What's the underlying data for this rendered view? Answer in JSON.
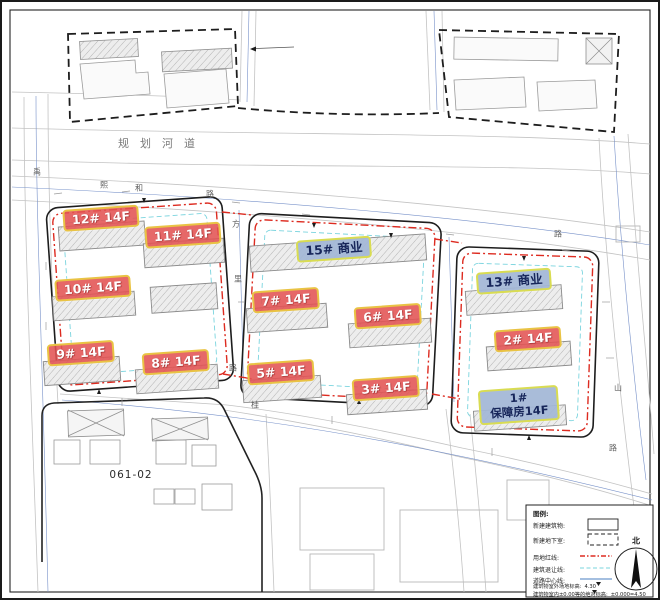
{
  "site": {
    "river_label": "规划河道",
    "parcel_id": "061-02",
    "north_label": "北",
    "roads": {
      "xihe": [
        "熙",
        "和",
        "路"
      ],
      "gap_left": [
        "方",
        "里",
        "路"
      ],
      "right_edge": [
        "山",
        "路"
      ],
      "top_right": "路",
      "bottom": "桂",
      "left_edge": "禹"
    },
    "buildings": [
      {
        "id": "12",
        "label": "12# 14F",
        "type": "residential"
      },
      {
        "id": "11",
        "label": "11# 14F",
        "type": "residential"
      },
      {
        "id": "10",
        "label": "10# 14F",
        "type": "residential"
      },
      {
        "id": "9",
        "label": "9# 14F",
        "type": "residential"
      },
      {
        "id": "8",
        "label": "8# 14F",
        "type": "residential"
      },
      {
        "id": "15",
        "label": "15# 商业",
        "type": "commercial"
      },
      {
        "id": "7",
        "label": "7# 14F",
        "type": "residential"
      },
      {
        "id": "6",
        "label": "6# 14F",
        "type": "residential"
      },
      {
        "id": "5",
        "label": "5# 14F",
        "type": "residential"
      },
      {
        "id": "3",
        "label": "3# 14F",
        "type": "residential"
      },
      {
        "id": "13",
        "label": "13# 商业",
        "type": "commercial"
      },
      {
        "id": "2",
        "label": "2# 14F",
        "type": "residential"
      },
      {
        "id": "1",
        "label": "1#",
        "sublabel": "保障房14F",
        "type": "affordable-housing"
      }
    ],
    "legend": {
      "title": "图例:",
      "items": [
        {
          "label": "新建建筑物:"
        },
        {
          "label": "新建地下室:"
        },
        {
          "label": "用地红线:"
        },
        {
          "label": "建筑退让线:"
        },
        {
          "label": "道路中心线:"
        },
        {
          "label": "建筑物室外场地标高:",
          "value": "4.30"
        },
        {
          "label": "建筑物室内±0.00等的绝对标高:",
          "value": "±0.000=4.50"
        }
      ]
    },
    "colors": {
      "red_line": "#dd2b20",
      "setback_line": "#7ad4de",
      "centerline": "#7791c9",
      "label_red": "#e25353",
      "label_blue": "#a3b7d6",
      "label_border": "#e9c344"
    }
  }
}
